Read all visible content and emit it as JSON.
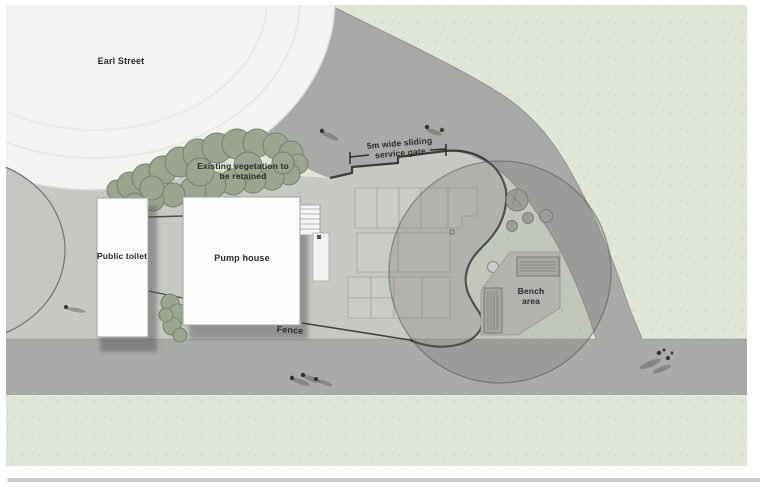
{
  "plan": {
    "street_label": "Earl Street",
    "vegetation_note": {
      "line1": "Existing vegetation to",
      "line2": "be retained"
    },
    "gate_note": {
      "line1": "5m wide sliding",
      "line2": "service gate"
    },
    "buildings": {
      "public_toilet": "Public toilet",
      "pump_house": "Pump house"
    },
    "fence_label": "Fence",
    "bench_area": {
      "line1": "Bench",
      "line2": "area"
    },
    "colors": {
      "grass": "#dfe5d7",
      "road": "#a7a9a6",
      "paved": "#c6c8c3",
      "building": "#fcfcfb",
      "vegetation": "#9aa48f",
      "boundary_line": "#3b3d3a",
      "overlay_circle": "rgba(125,127,123,0.30)",
      "page_rule": "#c7c7c7"
    }
  }
}
